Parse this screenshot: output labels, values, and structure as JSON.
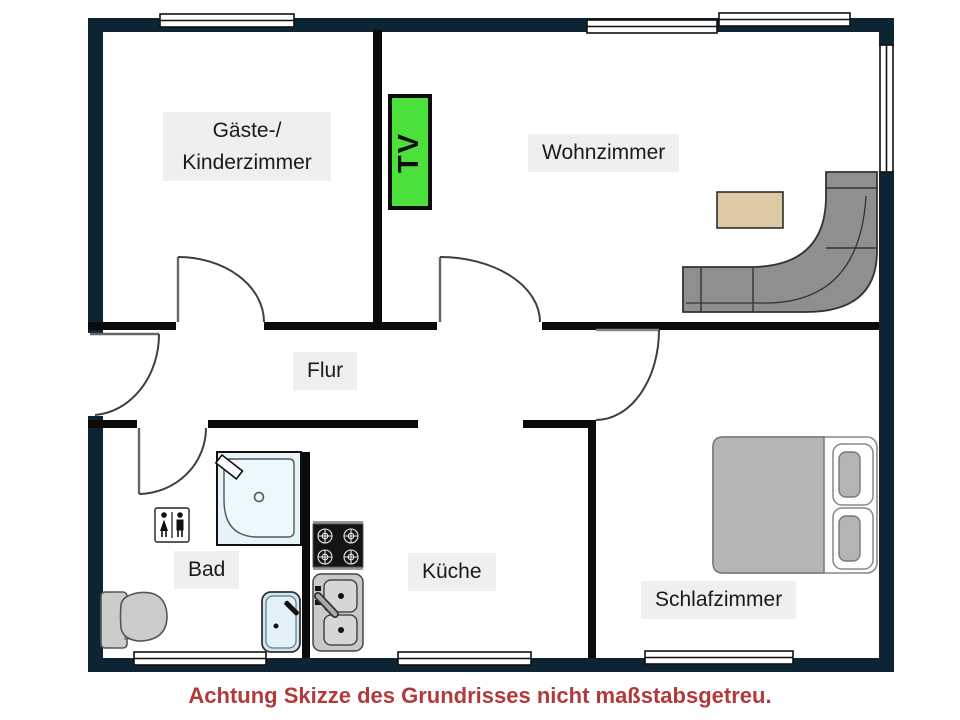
{
  "plan": {
    "type": "apartment-floor-plan",
    "note": "Achtung Skizze des Grundrisses nicht maßstabsgetreu."
  },
  "rooms": {
    "guest": {
      "line1": "Gäste-/",
      "line2": "Kinderzimmer"
    },
    "living": {
      "label": "Wohnzimmer"
    },
    "hall": {
      "label": "Flur"
    },
    "bath": {
      "label": "Bad"
    },
    "kitchen": {
      "label": "Küche"
    },
    "bedroom": {
      "label": "Schlafzimmer"
    }
  },
  "tv": {
    "label": "TV",
    "color": "#4be13a"
  },
  "colors": {
    "outer_wall": "#0d2433",
    "inner_wall": "#0b0b0b",
    "label_background": "#efefef",
    "label_text": "#1a1a1a",
    "note_red": "#b23a3a",
    "tv_green": "#4be13a",
    "coffee_table_beige": "#ddc9a4",
    "sofa_gray": "#8f8f8f",
    "bed_gray": "#b5b5b5",
    "fixture_blue": "#e6f4f8"
  },
  "symbols": [
    "window-icon",
    "door-swing-icon",
    "tv-icon",
    "sofa-icon",
    "coffee-table-icon",
    "bed-icon",
    "shower-icon",
    "toilet-icon",
    "washbasin-icon",
    "wc-sign-icon",
    "stove-icon",
    "kitchen-sink-icon"
  ]
}
